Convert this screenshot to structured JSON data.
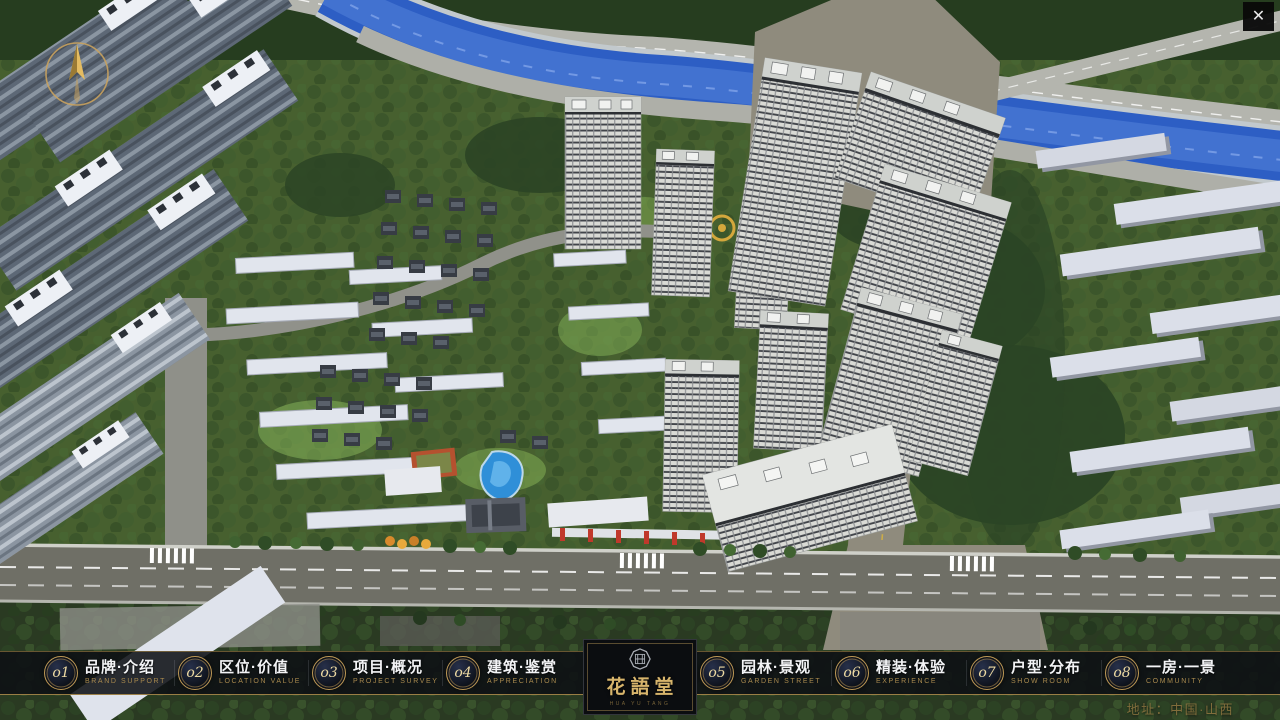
{
  "window": {
    "close_label": "✕"
  },
  "colors": {
    "accent_gold": "#bd9855",
    "bar_background": "rgba(13,15,19,0.87)",
    "river_blue": "#2d5ec4",
    "tree_green": "#2e4a27",
    "tower_white": "#d9dad5"
  },
  "menu": {
    "items": [
      {
        "num": "o1",
        "zh": "品牌·介绍",
        "en": "BRAND SUPPORT"
      },
      {
        "num": "o2",
        "zh": "区位·价值",
        "en": "LOCATION VALUE"
      },
      {
        "num": "o3",
        "zh": "项目·概况",
        "en": "PROJECT SURVEY"
      },
      {
        "num": "o4",
        "zh": "建筑·鉴赏",
        "en": "APPRECIATION"
      },
      {
        "num": "o5",
        "zh": "园林·景观",
        "en": "GARDEN STREET"
      },
      {
        "num": "o6",
        "zh": "精装·体验",
        "en": "EXPERIENCE"
      },
      {
        "num": "o7",
        "zh": "户型·分布",
        "en": "SHOW ROOM"
      },
      {
        "num": "o8",
        "zh": "一房·一景",
        "en": "COMMUNITY"
      }
    ]
  },
  "logo": {
    "name": "花語堂",
    "tagline": "HUA YU TANG"
  },
  "footer": {
    "address": "地址：中国·山西"
  },
  "scene": {
    "kind": "3d-aerial-masterplan"
  }
}
